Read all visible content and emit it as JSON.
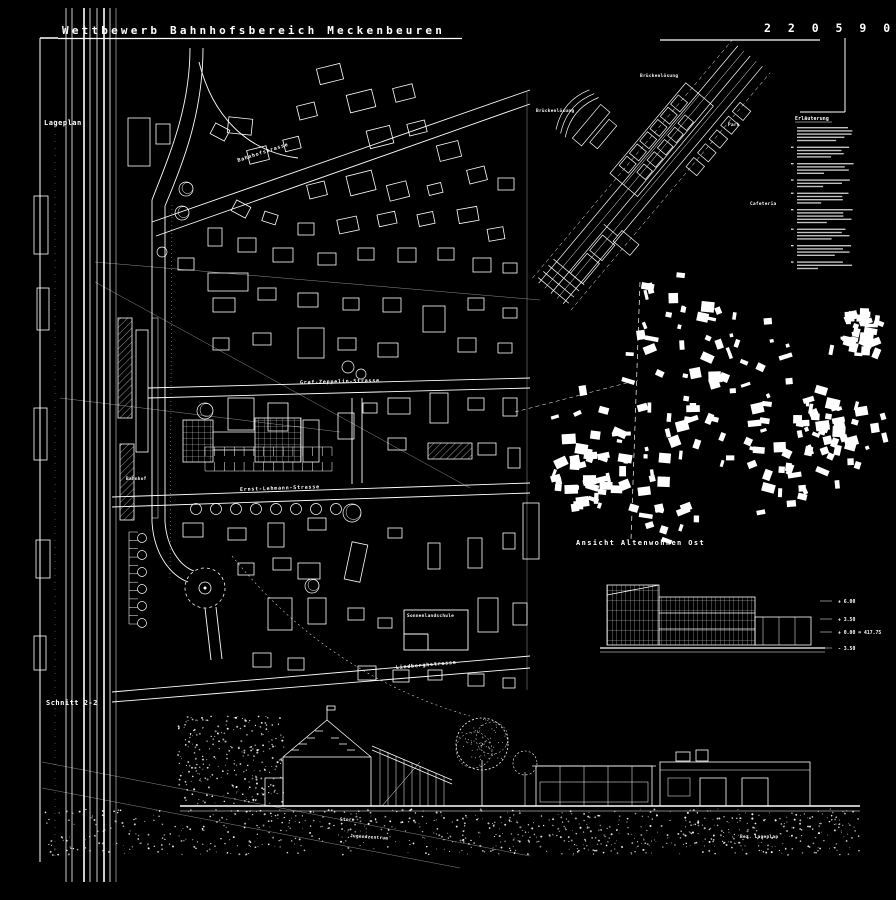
{
  "header": {
    "title": "Wettbewerb Bahnhofsbereich Meckenbeuren",
    "entry_number": "2 2 0 5 9 0"
  },
  "labels": {
    "lageplan": "Lageplan",
    "schnitt": "Schnitt 2-2",
    "ansicht_altenwohnen": "Ansicht Altenwohnen  Ost",
    "bahnhof": "Bahnhof",
    "sonnenlandschule": "Sonnenlandschule",
    "jugendzentrum": "Jugendzentrum",
    "store": "Store",
    "bez_lageplan": "Bez. Lageplan"
  },
  "streets": {
    "bahnhofstrasse": "Bahnhofstrasse",
    "graf_zeppelin": "Graf-Zeppelin-Strasse",
    "ernst_lehmann": "Ernst-Lehmann-Strasse",
    "lindbergh": "Lindberghstrasse"
  },
  "axon": {
    "label_top": "Brückenlösung",
    "label_left": "Brückenlösung",
    "cafeteria": "Cafeteria",
    "park": "Park"
  },
  "levels": {
    "l1": "+ 6.00",
    "l2": "+ 3.50",
    "l3": "+ 0.00 = 417.75",
    "l4": "- 3.50"
  },
  "legend": {
    "title": "Erläuterung"
  },
  "colors": {
    "background": "#000000",
    "ink": "#ffffff"
  }
}
